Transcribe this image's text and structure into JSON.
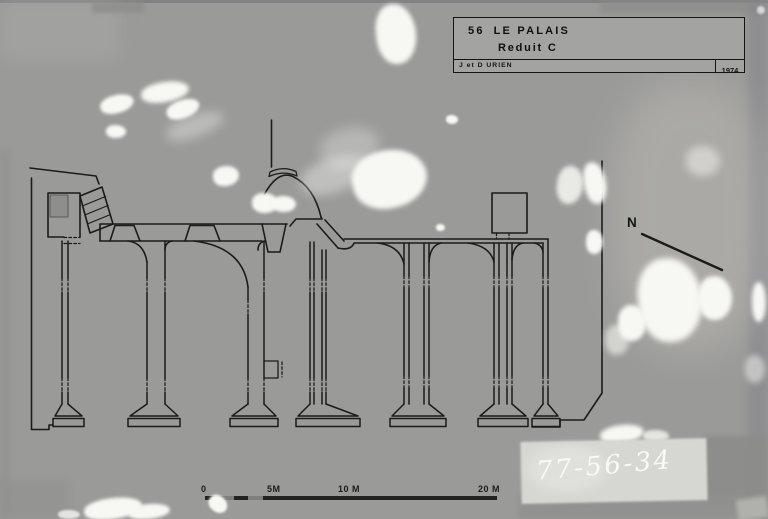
{
  "photo": {
    "description": "archival photograph of an architectural floor plan drawing",
    "title_block": {
      "sheet_number": "56",
      "title": "LE PALAIS",
      "subtitle": "Reduit C",
      "authors": "J et D URIEN",
      "year": "1974"
    },
    "north": {
      "label": "N",
      "icon": "north-arrow"
    },
    "scale_bar": {
      "labels": [
        "0",
        "5M",
        "10 M",
        "20 M"
      ]
    },
    "handwritten_reference": "77-56-34",
    "colors": {
      "background": "#9a9a98",
      "ink": "#1b1b1b",
      "damage_white": "#f7f7f4",
      "patch": "#d6d6d2"
    }
  }
}
